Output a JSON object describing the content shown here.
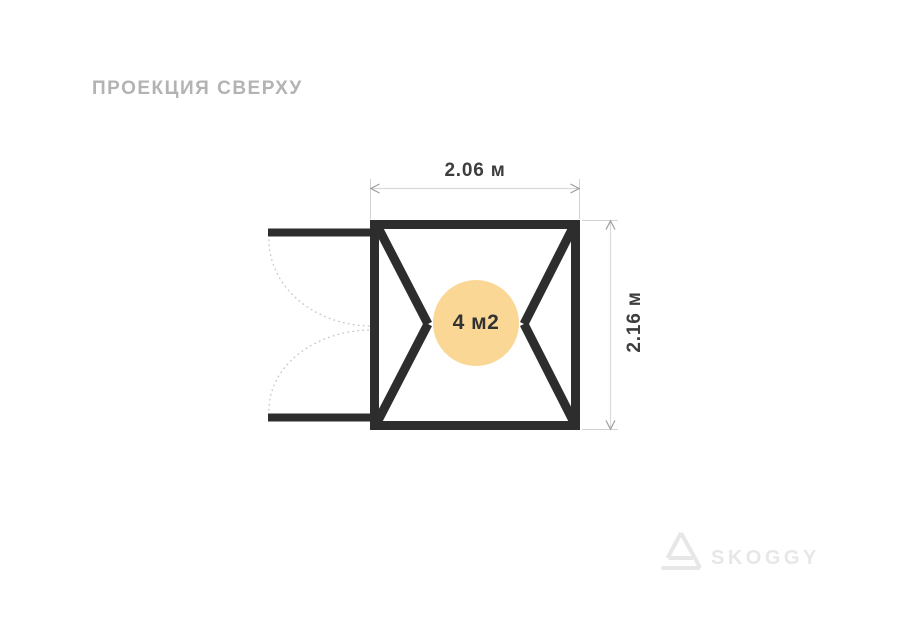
{
  "page": {
    "title": "ПРОЕКЦИЯ СВЕРХУ",
    "background": "#ffffff"
  },
  "diagram": {
    "width_label": "2.06 м",
    "height_label": "2.16 м",
    "area_label": "4 м2",
    "colors": {
      "frame": "#2e2d2e",
      "area_circle": "#fad795",
      "dim_line": "#dadada",
      "extension_line": "#d2d2d2",
      "dim_arrow": "#9e9e9e",
      "door_arc": "#c9c9c9",
      "dim_text": "#3d3d3d",
      "title_text": "#b3b3b3"
    }
  },
  "logo": {
    "text": "SKOGGY",
    "icon": "skoggy-triangle-logo",
    "color": "#e7e7e7"
  }
}
